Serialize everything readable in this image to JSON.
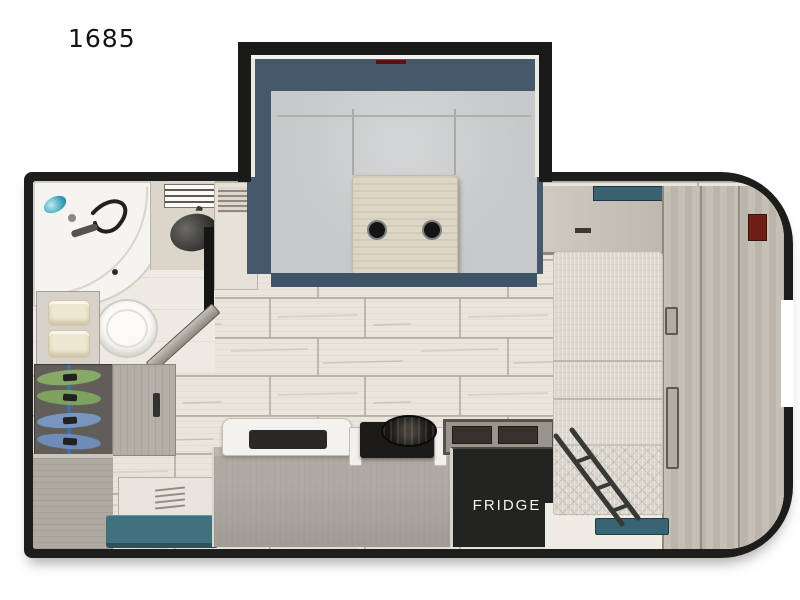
{
  "floorplan": {
    "model": "1685",
    "kind": "travel-trailer-floorplan",
    "labels": {
      "fridge": "FRIDGE"
    },
    "rooms": [
      {
        "name": "bathroom",
        "fixtures": [
          "shower",
          "toilet",
          "vanity-sink",
          "window-blinds",
          "linen-shelf",
          "bathroom-door"
        ]
      },
      {
        "name": "entry-storage",
        "fixtures": [
          "hanging-wardrobe",
          "green-hangers",
          "blue-hangers",
          "cabinet",
          "entry-step",
          "teal-step-mat"
        ]
      },
      {
        "name": "galley",
        "fixtures": [
          "kitchen-sink",
          "two-burner-cooktop",
          "refrigerator",
          "flip-up-counter"
        ]
      },
      {
        "name": "dinette-slideout",
        "fixtures": [
          "u-shaped-dinette",
          "dinette-table",
          "cup-holder",
          "cup-holder"
        ]
      },
      {
        "name": "bedroom",
        "fixtures": [
          "bed",
          "overhead-cabinet",
          "bed-window",
          "wardrobe-column",
          "bunk-ladder",
          "grab-handles"
        ]
      }
    ],
    "colors": {
      "wall": "#1d1d1c",
      "slide_interior_slate": "#46596a",
      "cushion_gray": "#c6c8c9",
      "table_wood": "#ddd6c5",
      "floor_tile": "#e9e5dc",
      "floor_grout": "#b2ab9f",
      "cabinet_wood": "#b4aea6",
      "fridge_black": "#232322",
      "mattress": "#dcd8cf",
      "teal_accent": "#41707f",
      "hanger_green": "#86a968",
      "hanger_blue": "#7795bf",
      "vent_red": "#6f1e15",
      "shower_head_teal": "#41a4bc"
    }
  }
}
